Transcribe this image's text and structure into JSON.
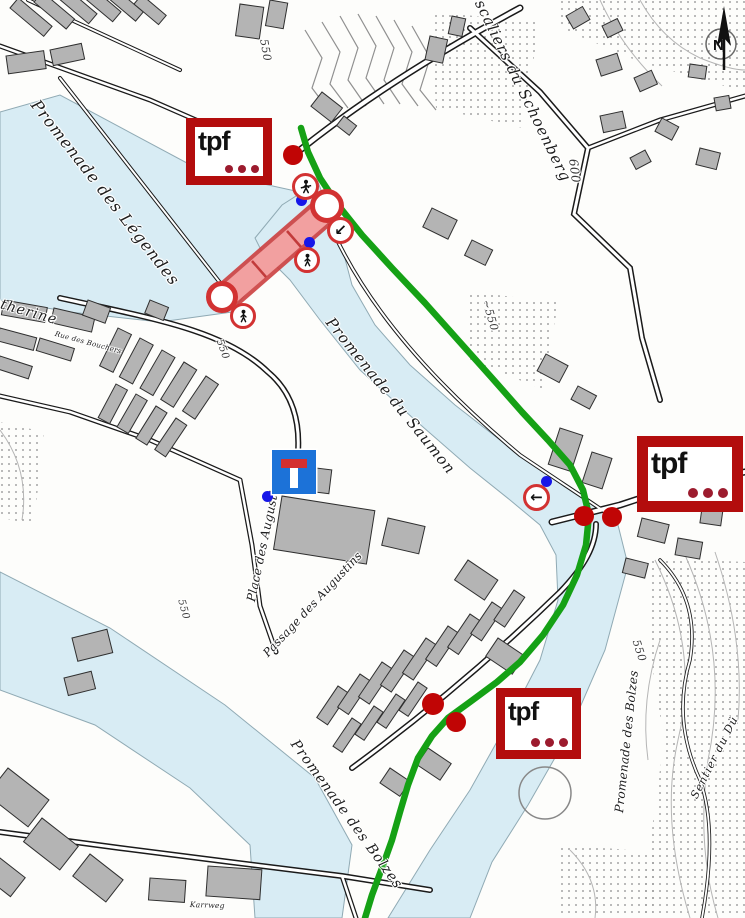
{
  "map_type": "city-detour-map",
  "colors": {
    "route_green": "#15a115",
    "closure_border_red": "#cc4040",
    "closure_fill_red": "#f2a0a0",
    "tpf_box_red": "#b30d0d",
    "tpf_dot_red": "#9c1b2e",
    "bus_stop_dot_red": "#c00505",
    "marker_blue": "#1616e8",
    "dead_end_sign_blue": "#1c72d8",
    "river_blue": "#d8ecf4"
  },
  "tpf_logo": {
    "text": "tpf"
  },
  "compass": {
    "label": "N"
  },
  "labels": {
    "streets": [
      {
        "id": "promenade-des-legendes",
        "text": "Promenade des Légendes"
      },
      {
        "id": "catherine",
        "text": "atherine"
      },
      {
        "id": "rue-des-bouchers",
        "text": "Rue des Bouchers"
      },
      {
        "id": "promenade-du-saumon",
        "text": "Promenade du Saumon"
      },
      {
        "id": "escaliers-du-schoenberg",
        "text": "Escaliers du Schoenberg"
      },
      {
        "id": "place-des-augustins",
        "text": "Place des Augustins"
      },
      {
        "id": "passage-des-augustins",
        "text": "Passage des Augustins"
      },
      {
        "id": "promenade-des-bolzes-sw",
        "text": "Promenade des Bolzes"
      },
      {
        "id": "promenade-des-bolzes-e",
        "text": "Promenade des Bolzes"
      },
      {
        "id": "sentier-du-du",
        "text": "Sentier du Dü"
      },
      {
        "id": "karrweg",
        "text": "Karrweg"
      }
    ],
    "elevations": [
      {
        "text": "550"
      },
      {
        "text": "600"
      },
      {
        "text": "~550"
      },
      {
        "text": "550"
      },
      {
        "text": "550"
      },
      {
        "text": "550"
      }
    ]
  },
  "icons": {
    "arrow_down_left": {
      "name": "arrow-down-left-icon",
      "glyph": "↙"
    },
    "arrow_left": {
      "name": "arrow-left-icon",
      "glyph": "←"
    },
    "pedestrian": {
      "name": "pedestrian-icon"
    },
    "no_pedestrian": {
      "name": "no-pedestrian-icon"
    },
    "road_closed": {
      "name": "road-closed-icon"
    },
    "dead_end": {
      "name": "dead-end-sign-icon"
    }
  },
  "markers": {
    "tpf_logo_count": 3,
    "bus_stop_dot_count": 5,
    "blue_point_count": 4,
    "closed_bridge_highlight": "red shaded bridge segment",
    "detour_route": "green line"
  }
}
